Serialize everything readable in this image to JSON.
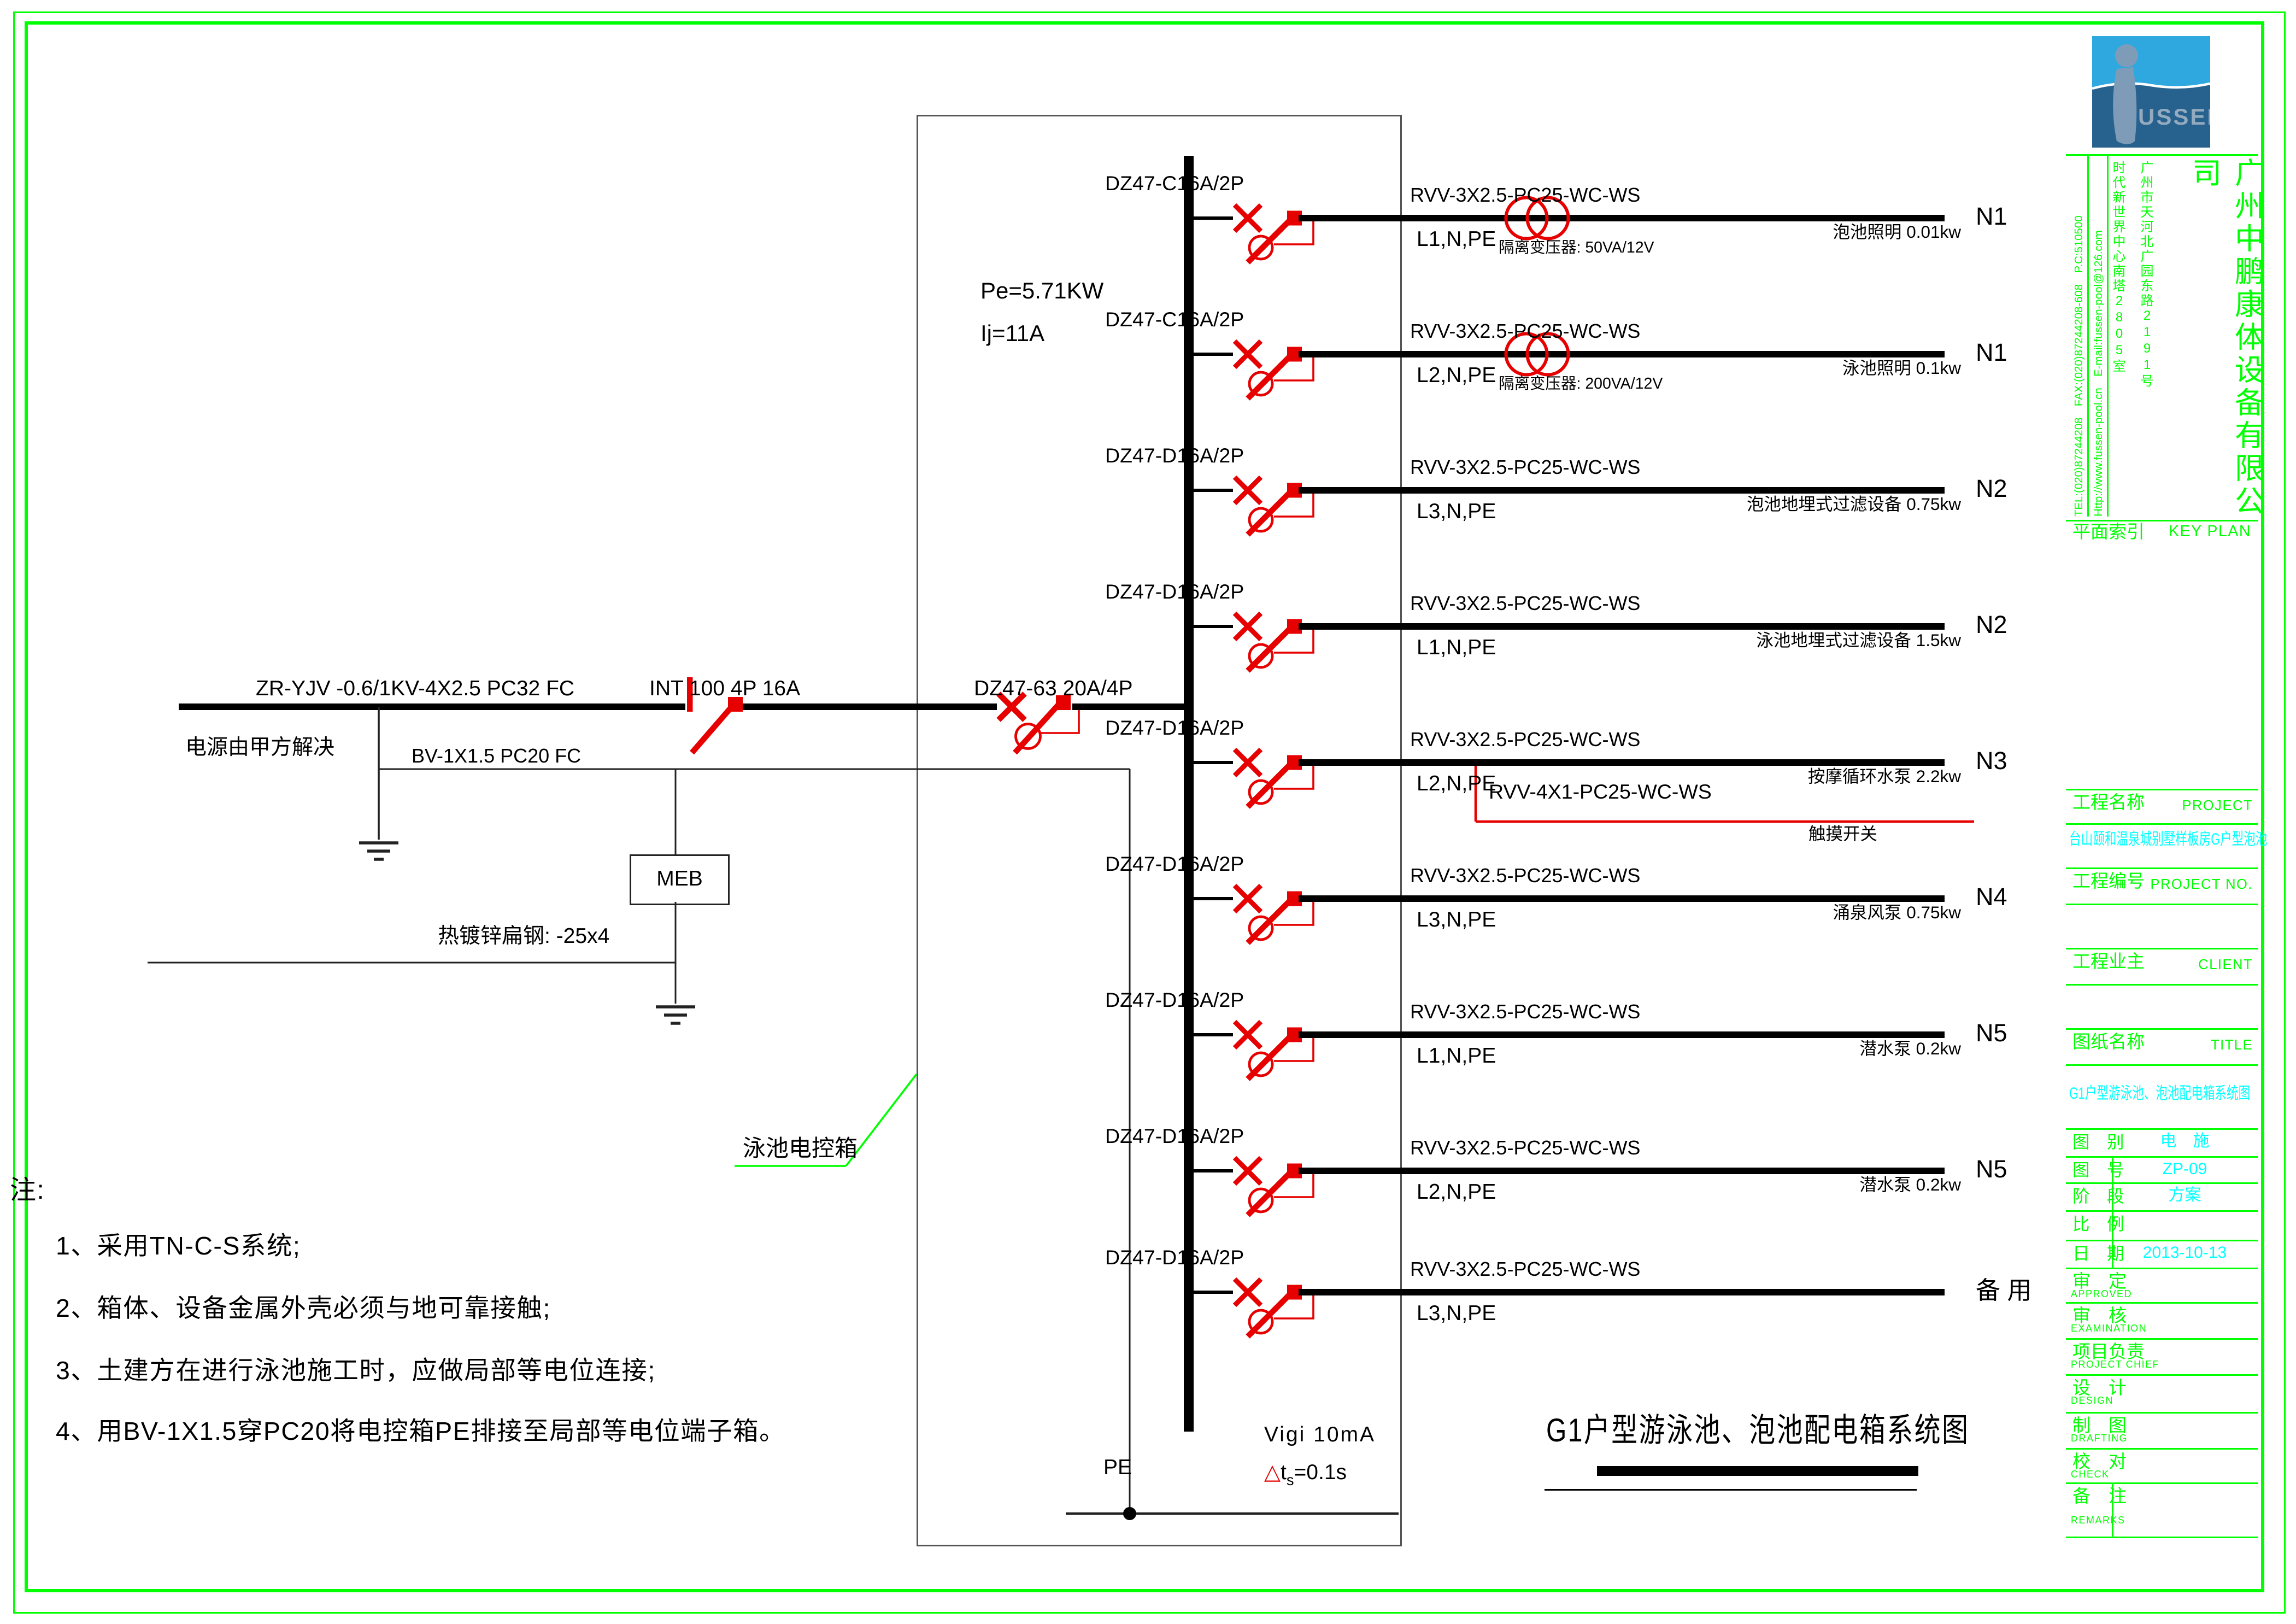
{
  "colors": {
    "accent_green": "#00ff00",
    "value_cyan": "#00ffff",
    "symbol_red": "#e60000",
    "logo_sky": "#2ea8df",
    "logo_sea": "#27628f",
    "logo_figure": "#7e9cb8"
  },
  "sheet": {
    "title": "G1户型游泳池、泡池配电箱系统图",
    "box_label": "泳池电控箱",
    "notes_heading": "注:",
    "notes": [
      "1、采用TN-C-S系统;",
      "2、箱体、设备金属外壳必须与地可靠接触;",
      "3、土建方在进行泳池施工时，应做局部等电位连接;",
      "4、用BV-1X1.5穿PC20将电控箱PE排接至局部等电位端子箱。"
    ]
  },
  "incoming": {
    "cable": "ZR-YJV -0.6/1KV-4X2.5 PC32  FC",
    "source": "电源由甲方解决",
    "pe_cable": "BV-1X1.5 PC20 FC",
    "isolator": "INT 100 4P 16A",
    "main_breaker": "DZ47-63 20A/4P",
    "power": "Pe=5.71KW",
    "current": "Ij=11A",
    "meb": "MEB",
    "earth_strip": "热镀锌扁钢: -25x4",
    "pe_label": "PE",
    "rcd": "Vigi  10mA",
    "rcd_delta": "△",
    "rcd_t": "t",
    "rcd_sub": "s",
    "rcd_val": "=0.1s"
  },
  "tap": {
    "cable": "RVV-4X1-PC25-WC-WS",
    "switch_label": "触摸开关"
  },
  "branches": [
    {
      "breaker": "DZ47-C16A/2P",
      "cable": "RVV-3X2.5-PC25-WC-WS",
      "phases": "L1,N,PE",
      "transformer": "隔离变压器: 50VA/12V",
      "load": "泡池照明 0.01kw",
      "n": "N1"
    },
    {
      "breaker": "DZ47-C16A/2P",
      "cable": "RVV-3X2.5-PC25-WC-WS",
      "phases": "L2,N,PE",
      "transformer": "隔离变压器: 200VA/12V",
      "load": "泳池照明 0.1kw",
      "n": "N1"
    },
    {
      "breaker": "DZ47-D16A/2P",
      "cable": "RVV-3X2.5-PC25-WC-WS",
      "phases": "L3,N,PE",
      "load": "泡池地埋式过滤设备 0.75kw",
      "n": "N2"
    },
    {
      "breaker": "DZ47-D16A/2P",
      "cable": "RVV-3X2.5-PC25-WC-WS",
      "phases": "L1,N,PE",
      "load": "泳池地埋式过滤设备 1.5kw",
      "n": "N2"
    },
    {
      "breaker": "DZ47-D16A/2P",
      "cable": "RVV-3X2.5-PC25-WC-WS",
      "phases": "L2,N,PE",
      "load": "按摩循环水泵 2.2kw",
      "n": "N3",
      "tap": true
    },
    {
      "breaker": "DZ47-D16A/2P",
      "cable": "RVV-3X2.5-PC25-WC-WS",
      "phases": "L3,N,PE",
      "load": "涌泉风泵 0.75kw",
      "n": "N4"
    },
    {
      "breaker": "DZ47-D16A/2P",
      "cable": "RVV-3X2.5-PC25-WC-WS",
      "phases": "L1,N,PE",
      "load": "潜水泵 0.2kw",
      "n": "N5"
    },
    {
      "breaker": "DZ47-D16A/2P",
      "cable": "RVV-3X2.5-PC25-WC-WS",
      "phases": "L2,N,PE",
      "load": "潜水泵 0.2kw",
      "n": "N5"
    },
    {
      "breaker": "DZ47-D16A/2P",
      "cable": "RVV-3X2.5-PC25-WC-WS",
      "phases": "L3,N,PE",
      "load": "",
      "n": "备 用"
    }
  ],
  "titleblock": {
    "logo_text": "USSEN",
    "company": {
      "tel": "TEL:(020)87244208　FAX:(020)87244208-608　P.C:510500",
      "web": "Http://www.fussen-pool.cn　E-mail:fussen-pool@126.com",
      "addr1": "广州市天河北广园东路2191号",
      "addr2": "时代新世界中心南塔2805室",
      "name": "广州中鹏康体设备有限公司"
    },
    "keyplan": {
      "label": "平面索引",
      "en": "KEY PLAN"
    },
    "project": {
      "label": "工程名称",
      "en": "PROJECT",
      "value": "台山颐和温泉城别墅样板房G户型泡池"
    },
    "project_no": {
      "label": "工程编号",
      "en": "PROJECT NO."
    },
    "client": {
      "label": "工程业主",
      "en": "CLIENT"
    },
    "drawing": {
      "label": "图纸名称",
      "en": "TITLE",
      "value": "G1户型游泳池、泡池配电箱系统图"
    },
    "fields": [
      {
        "label": "图　别",
        "value": "电　施"
      },
      {
        "label": "图　号",
        "value": "ZP-09"
      },
      {
        "label": "阶　段",
        "value": "方案"
      },
      {
        "label": "比　例",
        "value": ""
      },
      {
        "label": "日　期",
        "value": "2013-10-13"
      }
    ],
    "sign_rows": [
      {
        "label": "审　定",
        "en": "APPROVED"
      },
      {
        "label": "审　核",
        "en": "EXAMINATION"
      },
      {
        "label": "项目负责",
        "en": "PROJECT CHIEF"
      },
      {
        "label": "设　计",
        "en": "DESIGN"
      },
      {
        "label": "制　图",
        "en": "DRAFTING"
      },
      {
        "label": "校　对",
        "en": "CHECK"
      }
    ],
    "remarks": {
      "label": "备　注",
      "en": "REMARKS"
    }
  }
}
